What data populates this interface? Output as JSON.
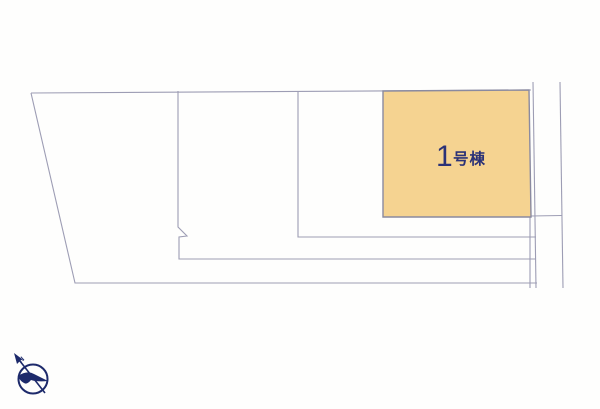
{
  "plot": {
    "label": "1号棟",
    "label_number": "1",
    "label_suffix": "号棟"
  },
  "compass": {
    "label": "N"
  },
  "colors": {
    "background": "#FEFEFD",
    "line": "#9D9DB4",
    "plot_fill": "#F5D391",
    "plot_border": "#8A8AA0",
    "label_text": "#2B3277",
    "compass": "#1D2A6B"
  }
}
